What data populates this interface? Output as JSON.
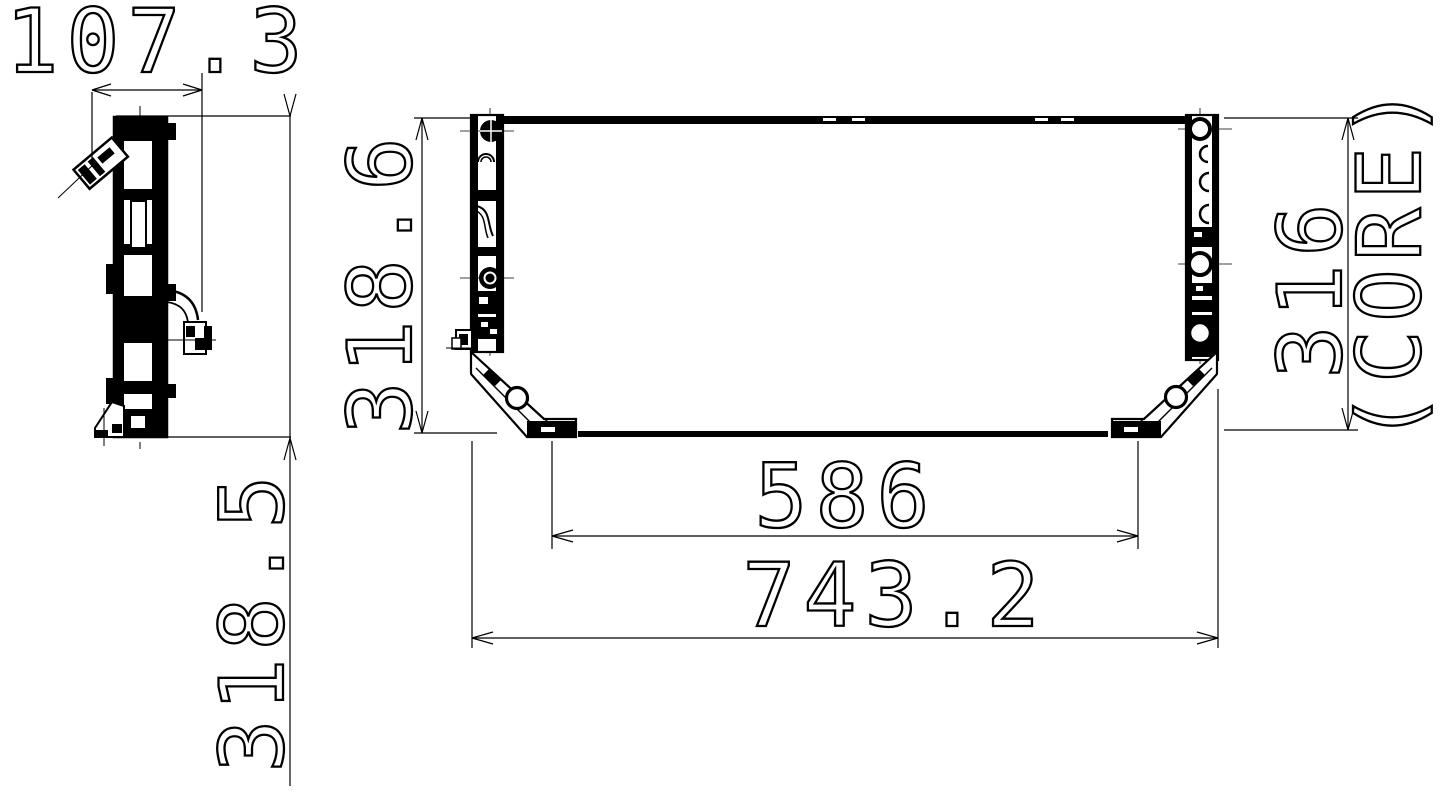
{
  "drawing": {
    "title": "condenser-technical-drawing",
    "line_color": "#000000",
    "background_color": "#ffffff",
    "views": {
      "side_view": "side-profile-view",
      "front_view": "front-view"
    },
    "dimensions": {
      "side_depth": {
        "value": "107.3",
        "orientation": "horizontal",
        "location": "top-left"
      },
      "side_height": {
        "value": "318.5",
        "orientation": "vertical",
        "location": "left"
      },
      "front_height": {
        "value": "318.6",
        "orientation": "vertical",
        "location": "front-left"
      },
      "mount_span": {
        "value": "586",
        "orientation": "horizontal",
        "location": "bottom"
      },
      "overall_width": {
        "value": "743.2",
        "orientation": "horizontal",
        "location": "bottom"
      },
      "core_height": {
        "value": "316",
        "orientation": "vertical",
        "location": "right"
      }
    },
    "core_label": "(CORE)"
  }
}
